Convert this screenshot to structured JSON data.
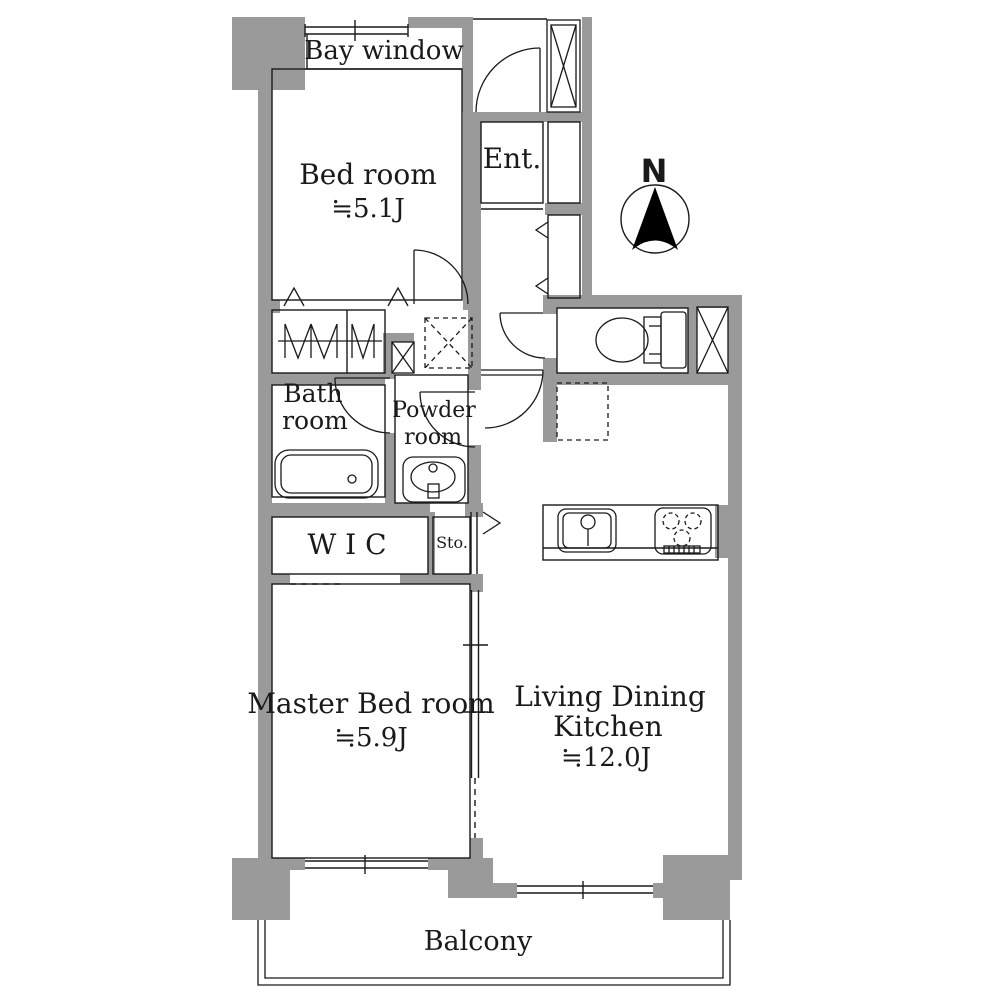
{
  "colors": {
    "wall": "#9a9a9a",
    "line": "#1a1a1a",
    "text": "#1a1a1a",
    "background": "#ffffff"
  },
  "compass": {
    "label": "N",
    "icon": "north-arrow-icon"
  },
  "rooms": {
    "bay_window": {
      "label": "Bay window"
    },
    "bedroom": {
      "label": "Bed room",
      "size": "≒5.1J"
    },
    "entrance": {
      "label": "Ent."
    },
    "bathroom": {
      "line1": "Bath",
      "line2": "room"
    },
    "powder_room": {
      "line1": "Powder",
      "line2": "room"
    },
    "wic": {
      "label": "W I C"
    },
    "storage": {
      "label": "Sto."
    },
    "master_bedroom": {
      "label": "Master Bed room",
      "size": "≒5.9J"
    },
    "ldk": {
      "line1": "Living Dining",
      "line2": "Kitchen",
      "size": "≒12.0J"
    },
    "balcony": {
      "label": "Balcony"
    }
  },
  "fixtures": {
    "toilet": "toilet-icon",
    "bathtub": "bathtub-icon",
    "vanity_sink": "vanity-sink-icon",
    "kitchen_sink": "kitchen-sink-icon",
    "stove": "stove-burners-icon",
    "washing_machine_space": "washing-machine-space",
    "refrigerator_space": "refrigerator-space",
    "pipe_space": "pipe-space-x-box",
    "closet_hanger": "hanger-rod-icon"
  }
}
